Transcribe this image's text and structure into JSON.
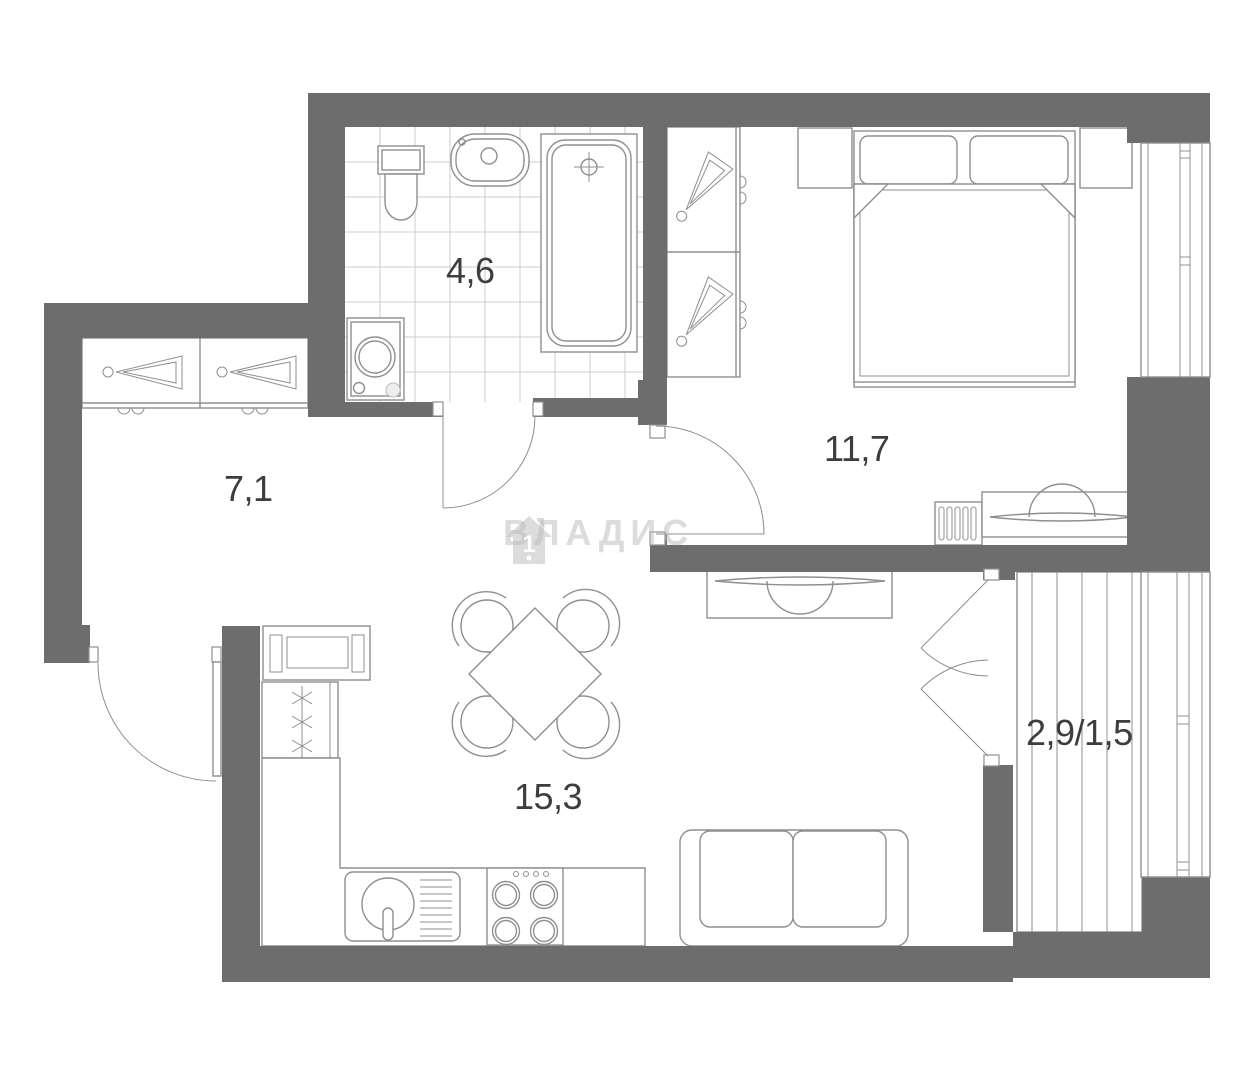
{
  "plan": {
    "type": "apartment-floor-plan",
    "watermark": {
      "brand_text": "ВЛАДИС",
      "house_number": "1"
    },
    "rooms": [
      {
        "id": "bathroom",
        "area_label": "4,6"
      },
      {
        "id": "hallway",
        "area_label": "7,1"
      },
      {
        "id": "bedroom",
        "area_label": "11,7"
      },
      {
        "id": "kitchen-living-room",
        "area_label": "15,3"
      },
      {
        "id": "balcony",
        "area_label": "2,9/1,5"
      }
    ],
    "colors": {
      "wall": "#6d6d6d",
      "furniture-line": "#8f8f8f",
      "tile-line": "#cccccc",
      "label-text": "#3d3d3d",
      "watermark": "rgba(185,185,185,0.5)"
    }
  }
}
